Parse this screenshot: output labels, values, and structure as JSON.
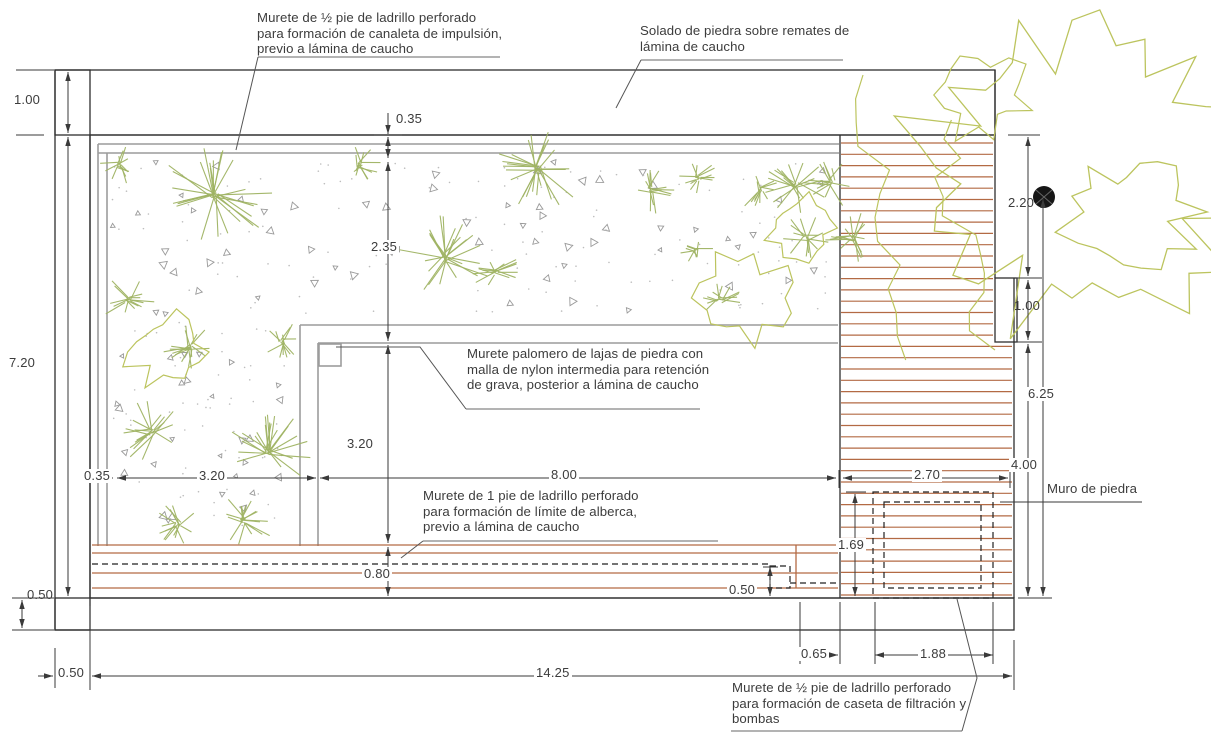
{
  "drawing": {
    "notes": {
      "canaleta": "Murete de ½ pie de ladrillo perforado\npara formación de canaleta de impulsión,\nprevio a lámina de caucho",
      "solado": "Solado de piedra sobre remates de\nlámina de caucho",
      "palomero": "Murete palomero de lajas de piedra con\nmalla de nylon intermedia para retención\nde grava, posterior a lámina de caucho",
      "limite": "Murete de 1 pie de ladrillo perforado\npara formación de límite de alberca,\nprevio a lámina de caucho",
      "caseta": "Murete de ½ pie de ladrillo perforado\npara formación de caseta de filtración y\nbombas",
      "muro_piedra": "Muro de piedra"
    },
    "dims": {
      "wall_top": "1.00",
      "interior_height": "7.20",
      "wall_bottom": "0.50",
      "wall_left": "0.50",
      "interior_width": "14.25",
      "canaleta_width": "0.35",
      "bed_margin": "0.35",
      "bed_width": "3.20",
      "bed_mid_height": "2.35",
      "pool_side": "3.20",
      "pool_width": "8.00",
      "beach_width": "0.80",
      "step": "0.50",
      "deck_width": "2.70",
      "caseta_depth": "1.69",
      "caseta_offset": "0.65",
      "caseta_w": "1.88",
      "tree_offset_top": "2.20",
      "wall_opening": "1.00",
      "tree_to_wall": "6.25",
      "stone_wall_length": "4.00"
    },
    "colors": {
      "line": "#3a3a3a",
      "hatch": "#ababab",
      "canaleta": "#9c9c9c",
      "brick": "#b36a44",
      "plant": "#a0b464",
      "canopy": "#bcc45e",
      "gravel": "#9a9a9a"
    }
  }
}
